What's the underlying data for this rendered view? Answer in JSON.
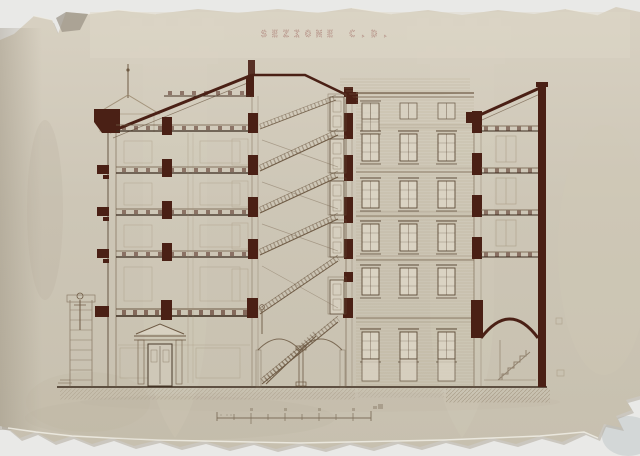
{
  "document": {
    "title": "SEZIONE C.D."
  },
  "colors": {
    "backdrop": "#e8e8e6",
    "paper": "#cfc8b9",
    "ink_dark_red": "#4a2015",
    "ink_sepia": "#6e5a44",
    "title_ink": "#b08a80"
  }
}
